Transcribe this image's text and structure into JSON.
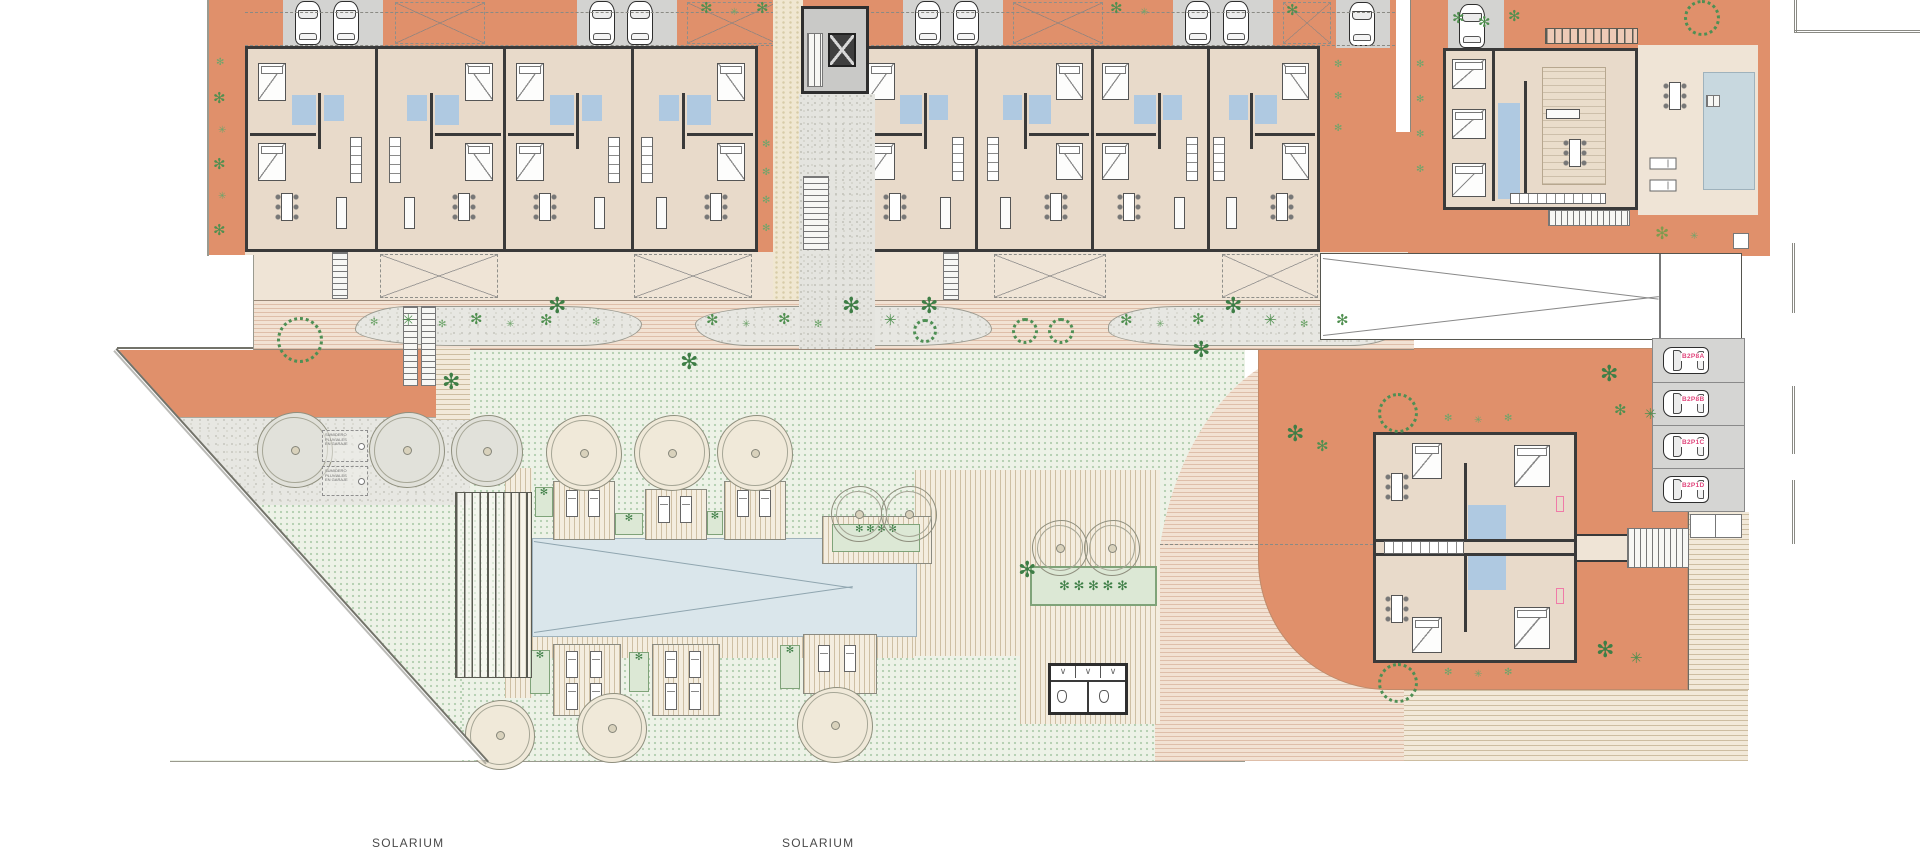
{
  "plan": {
    "solarium_label_1": "SOLARIUM",
    "solarium_label_2": "SOLARIUM"
  },
  "parking": {
    "spaces": [
      {
        "label": "B2P8A"
      },
      {
        "label": "B2P8B"
      },
      {
        "label": "B2P1C"
      },
      {
        "label": "B2P1D"
      }
    ],
    "label_color": "#E0457B"
  },
  "annotations": {
    "box1": [
      "SUMIDERO",
      "PLUVIALES",
      "EN GARAJE"
    ],
    "box2": [
      "SUMIDERO",
      "PLUVIALES",
      "EN GARAJE"
    ]
  },
  "icons": {
    "palm": "✻",
    "bush": "✳",
    "v_mark": "∨"
  },
  "colors": {
    "terracotta_ground": "#E0906B",
    "interior_floor": "#E8DACA",
    "walls": "#3A3A3A",
    "bathroom_blue": "#AFC9E1",
    "pool_water": "#DAE6EB",
    "lawn_green": "#EDF2E7",
    "parking_label_pink": "#E0457B"
  }
}
